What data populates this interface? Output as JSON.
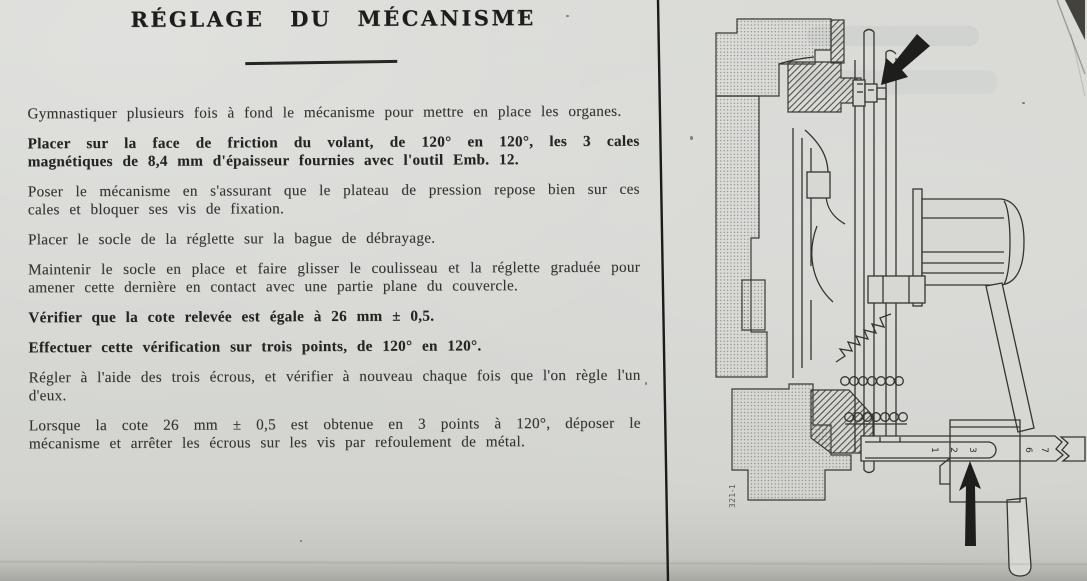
{
  "doc": {
    "title": "RÉGLAGE DU MÉCANISME",
    "paragraphs": [
      {
        "text": "Gymnastiquer plusieurs fois à fond le mécanisme pour mettre en place les organes.",
        "bold": false
      },
      {
        "text": "Placer sur la face de friction du volant, de 120° en 120°, les 3 cales magnétiques de 8,4 mm d'épaisseur fournies avec l'outil Emb. 12.",
        "bold": true
      },
      {
        "text": "Poser le mécanisme en s'assurant que le plateau de pression repose bien sur ces cales et bloquer ses vis de fixation.",
        "bold": false
      },
      {
        "text": "Placer le socle de la réglette sur la bague de débrayage.",
        "bold": false
      },
      {
        "text": "Maintenir le socle en place et faire glisser le coulisseau et la réglette graduée pour amener cette dernière en contact avec une partie plane du couvercle.",
        "bold": false
      },
      {
        "text": "Vérifier que la cote relevée est égale à 26 mm ± 0,5.",
        "bold": true
      },
      {
        "text": "Effectuer cette vérification sur trois points, de 120° en 120°.",
        "bold": true
      },
      {
        "text": "Régler à l'aide des trois écrous, et vérifier à nouveau chaque fois que l'on règle l'un d'eux.",
        "bold": false
      },
      {
        "text": "Lorsque la cote 26 mm ± 0,5 est obtenue en 3 points à 120°, déposer le mécanisme et arrêter les écrous sur les vis par refoulement de métal.",
        "bold": false
      }
    ]
  },
  "figure": {
    "caption_number": "321-1",
    "ruler_digits_left": [
      "1",
      "2",
      "3"
    ],
    "ruler_digits_right": [
      "6",
      "7"
    ]
  },
  "colors": {
    "paper": "#d6d7d3",
    "ink": "#2e2e2c",
    "line": "#35352f"
  }
}
